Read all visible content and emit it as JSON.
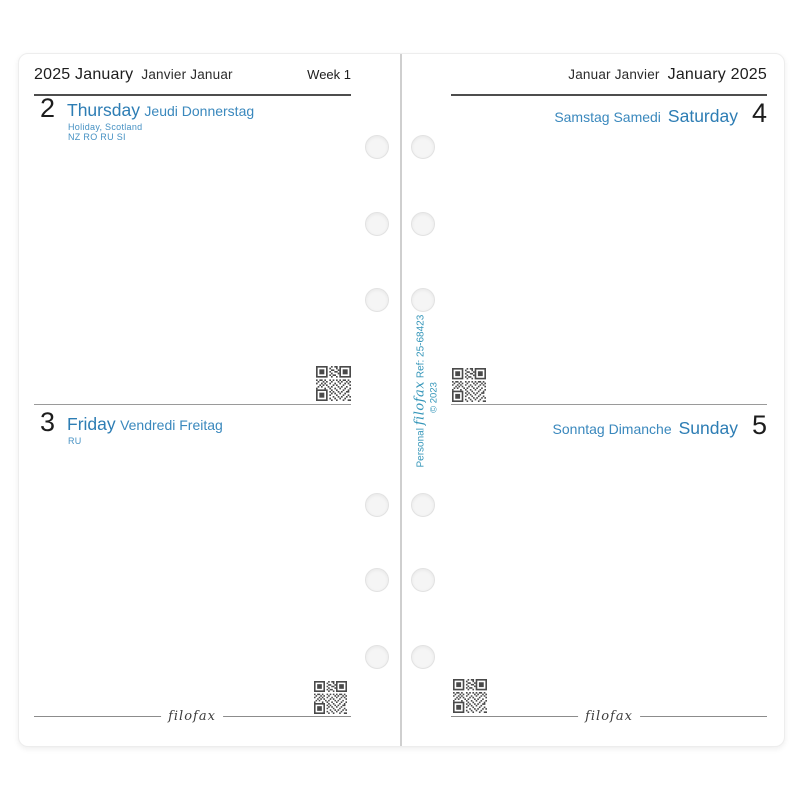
{
  "colors": {
    "accent_blue": "#2d7db4",
    "accent_blue_light": "#4691c3",
    "spine_teal": "#3596b9",
    "ink": "#1d1d1d"
  },
  "left_page": {
    "header": {
      "primary": "2025 January",
      "secondary": "Janvier Januar",
      "week_label": "Week 1"
    },
    "days": [
      {
        "number": "2",
        "name_primary": "Thursday",
        "name_secondary": "Jeudi Donnerstag",
        "note_line1": "Holiday, Scotland",
        "note_line2": "NZ  RO  RU  SI"
      },
      {
        "number": "3",
        "name_primary": "Friday",
        "name_secondary": "Vendredi Freitag",
        "note_line1": "RU"
      }
    ],
    "footer_logo": "filofax"
  },
  "right_page": {
    "header": {
      "secondary": "Januar Janvier",
      "primary": "January 2025"
    },
    "days": [
      {
        "number": "4",
        "name_secondary": "Samstag Samedi",
        "name_primary": "Saturday"
      },
      {
        "number": "5",
        "name_secondary": "Sonntag Dimanche",
        "name_primary": "Sunday"
      }
    ],
    "spine": {
      "size_label": "Personal",
      "brand": "filofax",
      "ref": "Ref: 25-68423",
      "copyright": "© 2023"
    },
    "footer_logo": "filofax"
  }
}
